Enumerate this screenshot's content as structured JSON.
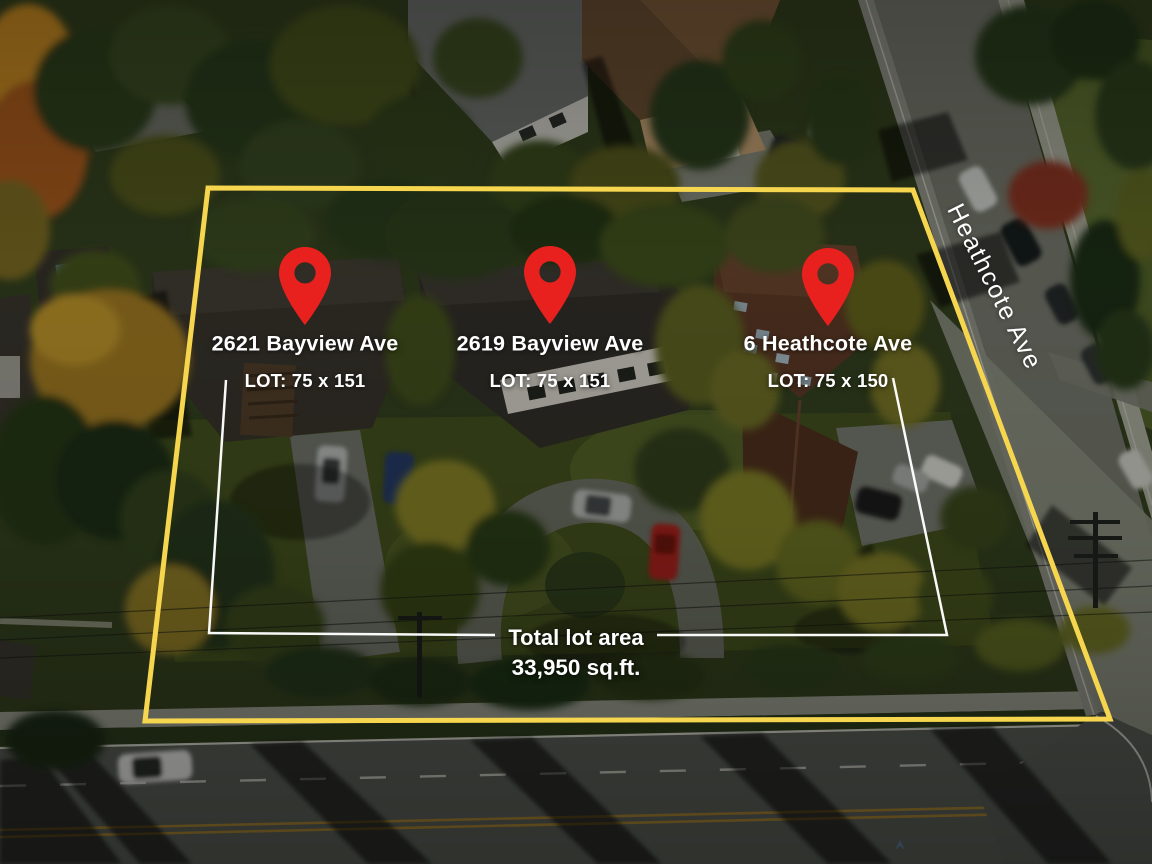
{
  "properties": [
    {
      "address": "2621 Bayview Ave",
      "lot": "LOT: 75 x 151"
    },
    {
      "address": "2619 Bayview Ave",
      "lot": "LOT: 75 x 151"
    },
    {
      "address": "6 Heathcote Ave",
      "lot": "LOT: 75 x 150"
    }
  ],
  "total_area": {
    "title": "Total lot area",
    "value": "33,950 sq.ft."
  },
  "street": {
    "name": "Heathcote Ave"
  },
  "colors": {
    "boundary": "#F6D64E",
    "pin": "#E8211E",
    "measurement": "#FFFFFF",
    "label_text": "#FFFFFF"
  }
}
